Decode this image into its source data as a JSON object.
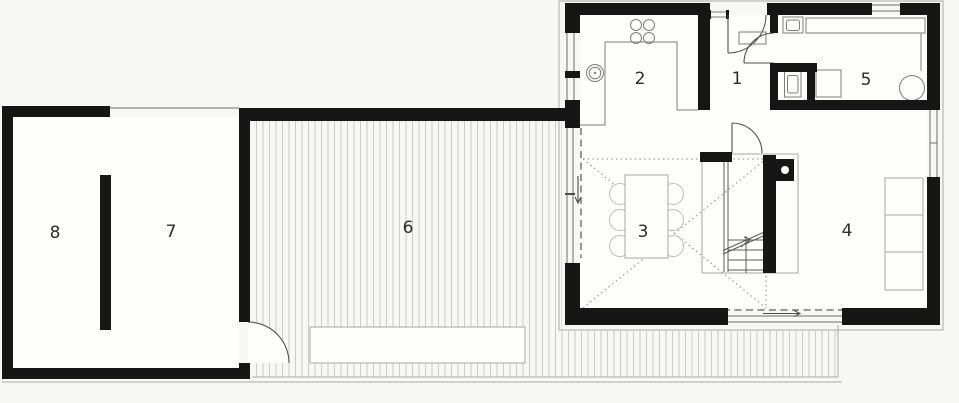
{
  "plan": {
    "title": "floor-plan",
    "rooms": [
      {
        "number": "1"
      },
      {
        "number": "2"
      },
      {
        "number": "3"
      },
      {
        "number": "4"
      },
      {
        "number": "5"
      },
      {
        "number": "6"
      },
      {
        "number": "7"
      },
      {
        "number": "8"
      }
    ]
  },
  "colors": {
    "background": "#f7f7f4",
    "floor": "#fdfdfc",
    "wall": "#161616",
    "furniture_line": "#a8a8a8",
    "fixture_line": "#7d7d7d",
    "deck_hatch": "#cbcbc7",
    "void_dotted": "#9b9b9b",
    "door_arc": "#4f4f4f",
    "label_text": "#2c2c2c"
  }
}
